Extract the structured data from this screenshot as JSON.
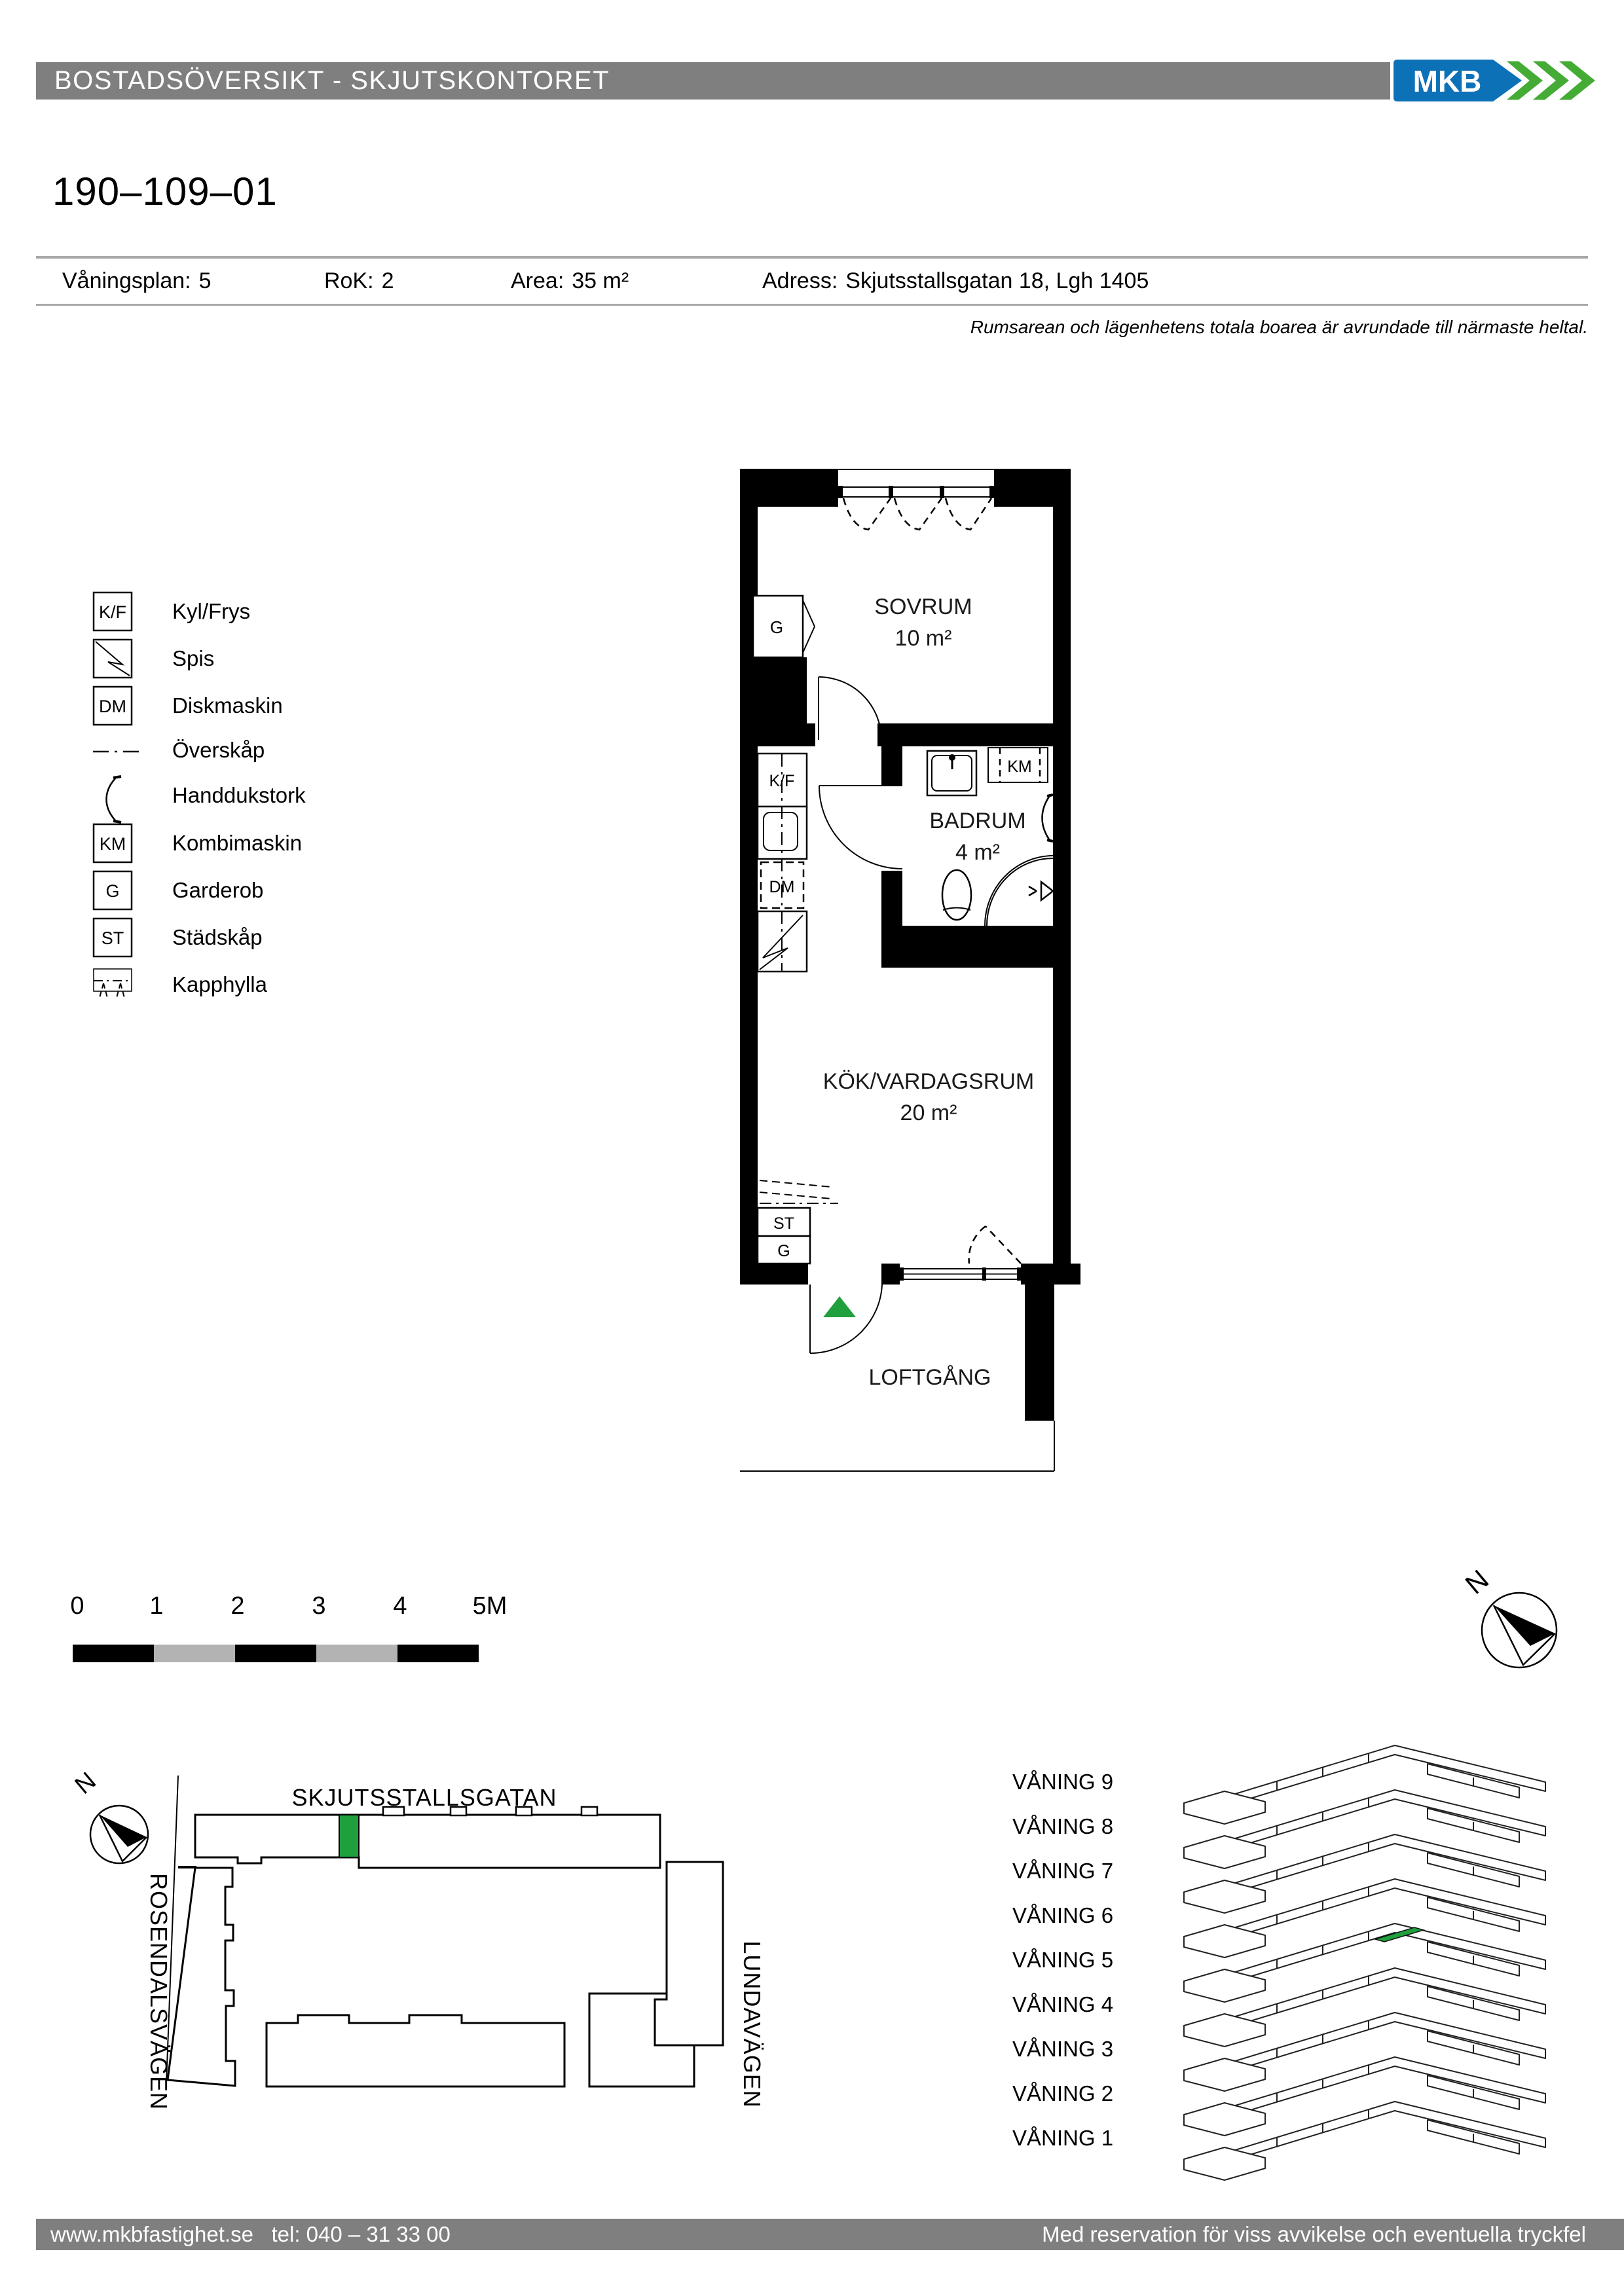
{
  "header": {
    "bar_title": "BOSTADSÖVERSIKT - SKJUTSKONTORET",
    "logo_text": "MKB"
  },
  "apartment": {
    "id": "190–109–01",
    "fields": [
      {
        "label": "Våningsplan:",
        "value": "5"
      },
      {
        "label": "RoK:",
        "value": "2"
      },
      {
        "label": "Area:",
        "value": "35 m²"
      },
      {
        "label": "Adress:",
        "value": "Skjutsstallsgatan 18, Lgh 1405"
      }
    ],
    "note": "Rumsarean och lägenhetens totala boarea är avrundade till närmaste heltal."
  },
  "legend": {
    "items": [
      {
        "key": "K/F",
        "label": "Kyl/Frys"
      },
      {
        "key": "",
        "label": "Spis"
      },
      {
        "key": "DM",
        "label": "Diskmaskin"
      },
      {
        "key": "",
        "label": "Överskåp"
      },
      {
        "key": "",
        "label": "Handdukstork"
      },
      {
        "key": "KM",
        "label": "Kombimaskin"
      },
      {
        "key": "G",
        "label": "Garderob"
      },
      {
        "key": "ST",
        "label": "Städskåp"
      },
      {
        "key": "",
        "label": "Kapphylla"
      }
    ]
  },
  "floorplan": {
    "rooms": [
      {
        "name": "SOVRUM",
        "area": "10 m²"
      },
      {
        "name": "BADRUM",
        "area": "4 m²"
      },
      {
        "name": "KÖK/VARDAGSRUM",
        "area": "20 m²"
      }
    ],
    "outside_label": "LOFTGÅNG",
    "fixtures": {
      "kf": "K/F",
      "dm": "DM",
      "km": "KM",
      "g_sovrum": "G",
      "st": "ST",
      "g_hall": "G"
    }
  },
  "scalebar": {
    "labels": [
      "0",
      "1",
      "2",
      "3",
      "4",
      "5M"
    ]
  },
  "compass": {
    "label": "N"
  },
  "sitemap": {
    "street_top": "SKJUTSSTALLSGATAN",
    "street_left": "ROSENDALSVÄGEN",
    "street_right": "LUNDAVÄGEN",
    "north_label": "N"
  },
  "floors": {
    "levels": [
      "VÅNING 9",
      "VÅNING 8",
      "VÅNING 7",
      "VÅNING 6",
      "VÅNING 5",
      "VÅNING 4",
      "VÅNING 3",
      "VÅNING 2",
      "VÅNING 1"
    ]
  },
  "footer": {
    "left": "www.mkbfastighet.se   tel: 040 – 31 33 00",
    "right": "Med reservation för viss avvikelse och eventuella tryckfel"
  },
  "colors": {
    "bar_gray": "#7f7f7f",
    "rule_gray": "#a8a8a8",
    "scale_light": "#b3b3b3",
    "highlight_green": "#1fa03c",
    "logo_blue": "#0d71b8",
    "logo_green": "#44ab35"
  }
}
